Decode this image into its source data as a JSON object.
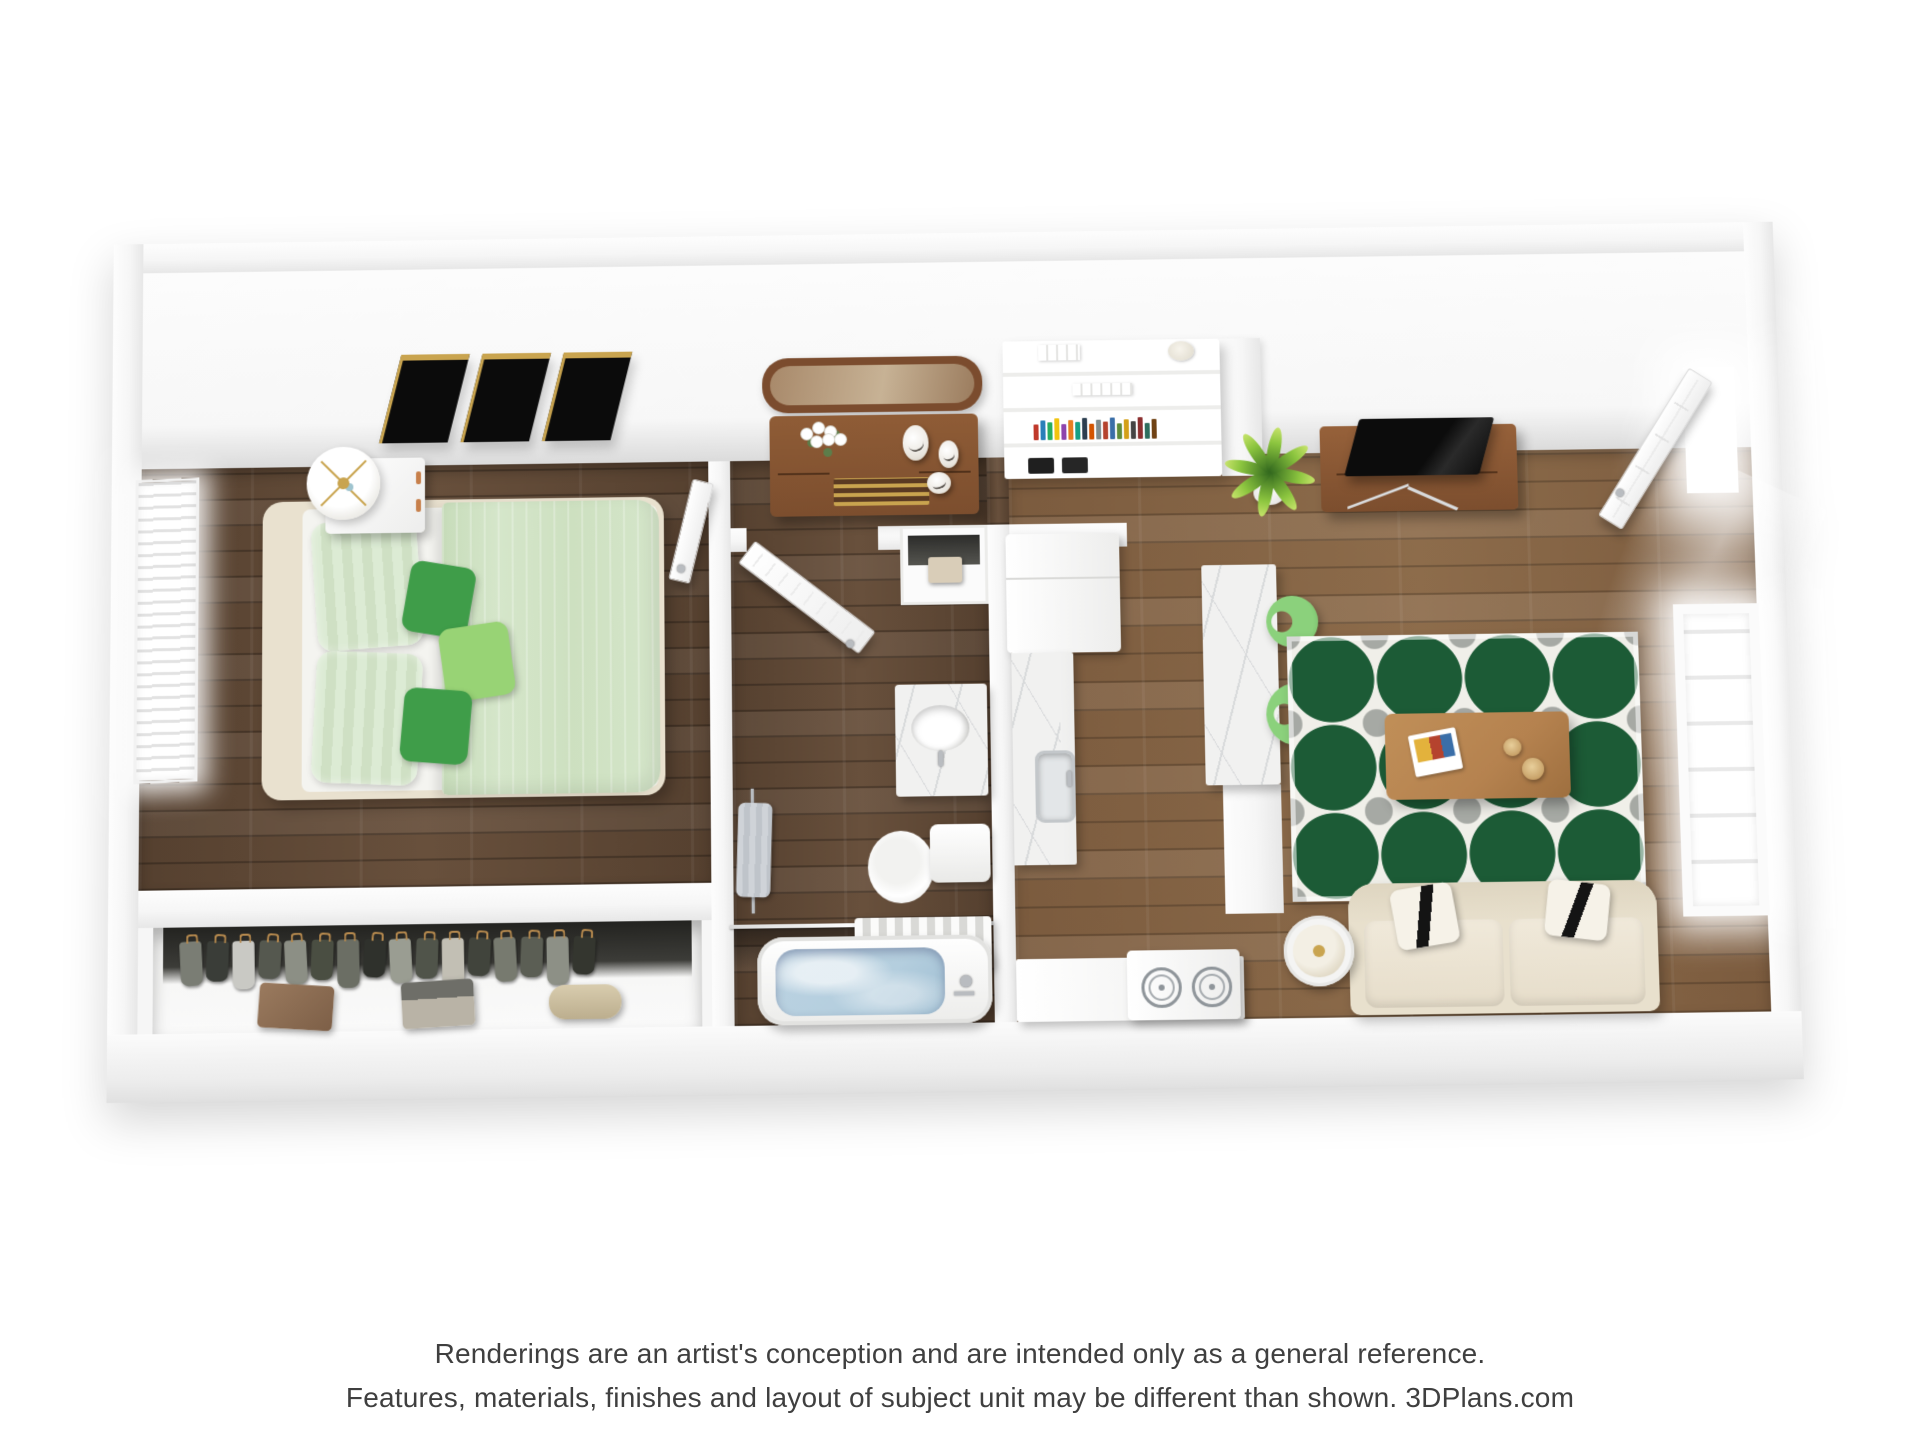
{
  "footer": {
    "line1": "Renderings are an artist's conception and are intended only as a general reference.",
    "line2": "Features, materials, finishes and layout of subject unit may be different than shown. 3DPlans.com"
  },
  "palette": {
    "wall": "#f6f6f6",
    "wall_shade": "#e7e7e7",
    "wall_edge": "#dcdcdc",
    "wood_dark": "#55402f",
    "wood_dark2": "#68503c",
    "wood_mid": "#7b5b3e",
    "wood_mid2": "#8d6c4b",
    "rug_green": "#1c5b36",
    "rug_base": "#f0efe9",
    "rug_gray": "#a6a9a4",
    "duvet": "#d5e6ca",
    "pillow_a": "#dcebd4",
    "pillow_b": "#cfe0c4",
    "green_dark": "#3f9d49",
    "green_light": "#98d375",
    "cream": "#e9e1cf",
    "mattress": "#f4f4f0",
    "sofa": "#e8e0cd",
    "sofa_cushion": "#f0e9da",
    "stool": "#8bd17c",
    "oak": "#b5824f",
    "walnut": "#7c4e2e",
    "walnut_light": "#8f5c36",
    "gold": "#c9a44f",
    "water": "#b4cede",
    "marble_vein": "#d8dadb",
    "plant_light": "#8cc53f",
    "metal": "#b9bcc0",
    "text": "#3f3f3f"
  },
  "bedroom": {
    "art_panel_count": 3
  },
  "closet": {
    "garments": [
      "#7a7d74",
      "#3a3d38",
      "#c9c9c4",
      "#55584f",
      "#8c8f85",
      "#4a4e42",
      "#6b6e64",
      "#2f312c",
      "#9a9d92",
      "#50544a",
      "#c2bfb4",
      "#41443c",
      "#777a6f",
      "#5b5e54",
      "#8d9086",
      "#34362f"
    ]
  },
  "bookshelf": {
    "spines": [
      "#c0392b",
      "#2980b9",
      "#27ae60",
      "#f1c40f",
      "#8e44ad",
      "#e67e22",
      "#16a085",
      "#2c3e50",
      "#d35400",
      "#7f8c8d",
      "#b5432e",
      "#3a6ea8",
      "#5e8c3a",
      "#d4a017",
      "#444444",
      "#8c2f2f",
      "#2e6e5e",
      "#704214"
    ]
  }
}
